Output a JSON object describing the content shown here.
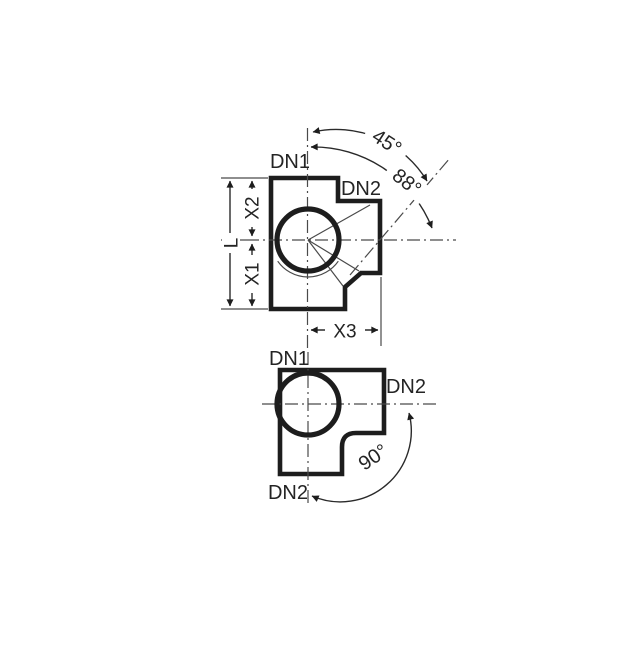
{
  "drawing": {
    "colors": {
      "background": "#ffffff",
      "line": "#1d1d1d",
      "thin": "#4a4a4a"
    },
    "figure_top": {
      "inlet_label": "DN1",
      "branch_label": "DN2",
      "dim_length": "L",
      "dim_x1": "X1",
      "dim_x2": "X2",
      "dim_x3": "X3",
      "angle_socket": "45°",
      "angle_branch": "88°"
    },
    "figure_bottom": {
      "inlet_label": "DN1",
      "outlet_right_label": "DN2",
      "outlet_bottom_label": "DN2",
      "angle_bend": "90°"
    }
  }
}
